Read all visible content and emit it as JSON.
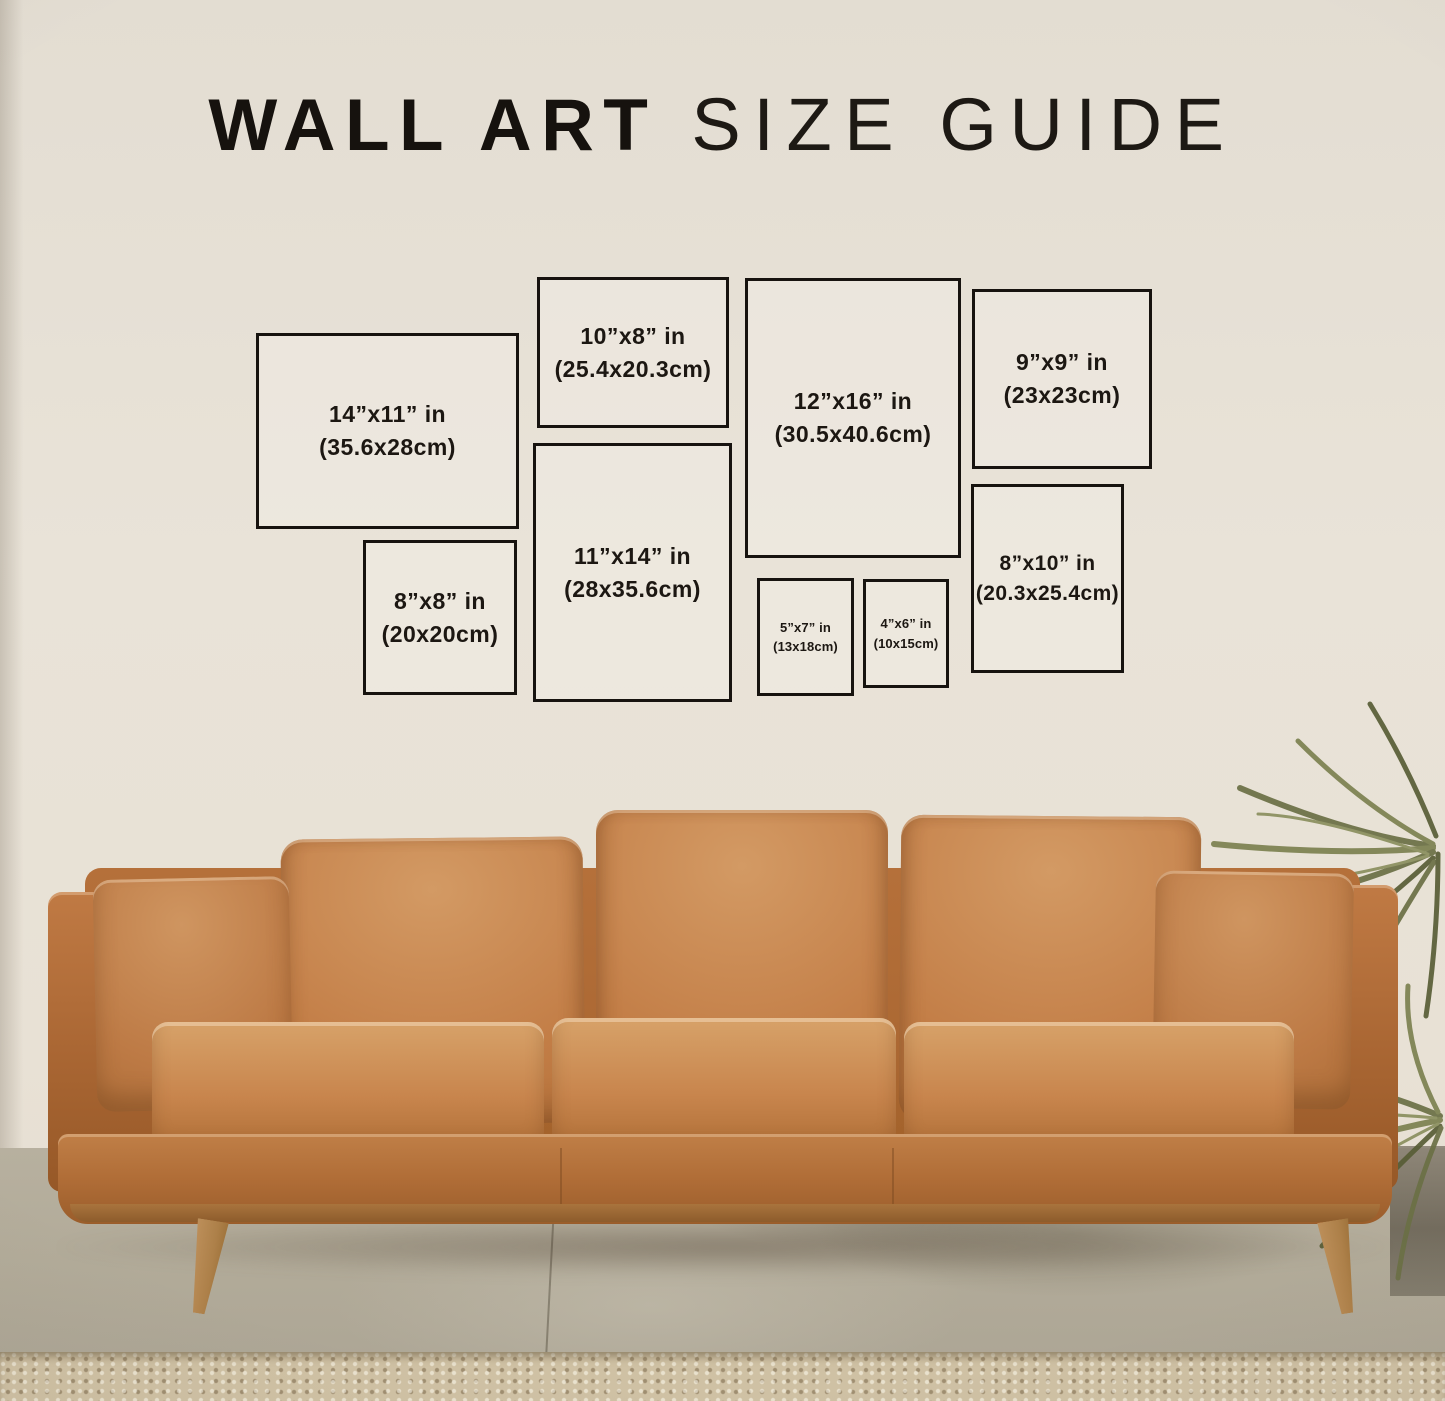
{
  "title": {
    "primary": "WALL ART",
    "secondary": "SIZE GUIDE"
  },
  "frames": [
    {
      "id": "14x11",
      "size_in": "14”x11” in",
      "size_cm": "(35.6x28cm)"
    },
    {
      "id": "10x8",
      "size_in": "10”x8” in",
      "size_cm": "(25.4x20.3cm)"
    },
    {
      "id": "12x16",
      "size_in": "12”x16” in",
      "size_cm": "(30.5x40.6cm)"
    },
    {
      "id": "9x9",
      "size_in": "9”x9” in",
      "size_cm": "(23x23cm)"
    },
    {
      "id": "8x8",
      "size_in": "8”x8” in",
      "size_cm": "(20x20cm)"
    },
    {
      "id": "11x14",
      "size_in": "11”x14” in",
      "size_cm": "(28x35.6cm)"
    },
    {
      "id": "5x7",
      "size_in": "5”x7” in",
      "size_cm": "(13x18cm)"
    },
    {
      "id": "4x6",
      "size_in": "4”x6” in",
      "size_cm": "(10x15cm)"
    },
    {
      "id": "8x10",
      "size_in": "8”x10” in",
      "size_cm": "(20.3x25.4cm)"
    }
  ],
  "colors": {
    "wall": "#e8e2d7",
    "frame_border": "#17130f",
    "text": "#1c1712",
    "sofa_leather": "#c08049",
    "wood_leg": "#ad8049",
    "floor_concrete": "#b2ab99",
    "rug": "#cfc1a4",
    "plant_green": "#6e7246"
  }
}
